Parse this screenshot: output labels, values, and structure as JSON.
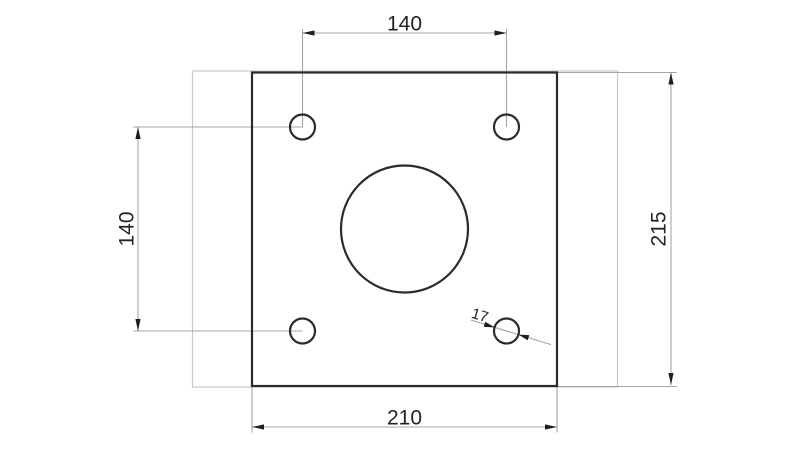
{
  "drawing": {
    "kind": "2D engineering drawing, front view of square mounting plate",
    "background": "#ffffff",
    "features": {
      "plate": "square plate outline",
      "corner_holes_count": 4,
      "center_bore_count": 1,
      "ghost_outline": "light reference rectangle behind plate"
    },
    "dimensions": {
      "hole_spacing_horizontal": {
        "value": "140",
        "orientation": "horizontal",
        "position": "top"
      },
      "hole_spacing_vertical": {
        "value": "140",
        "orientation": "vertical",
        "position": "left"
      },
      "plate_height": {
        "value": "215",
        "orientation": "vertical",
        "position": "right"
      },
      "plate_width": {
        "value": "210",
        "orientation": "horizontal",
        "position": "bottom"
      },
      "hole_diameter": {
        "value": "17",
        "orientation": "diagonal-leader",
        "position": "bottom-right hole"
      }
    },
    "colors": {
      "outline": "#2b2b2b",
      "dimension_lines": "#a6a6a6",
      "ghost_outline": "#c8c8c8",
      "text": "#242424",
      "background": "#ffffff"
    }
  }
}
